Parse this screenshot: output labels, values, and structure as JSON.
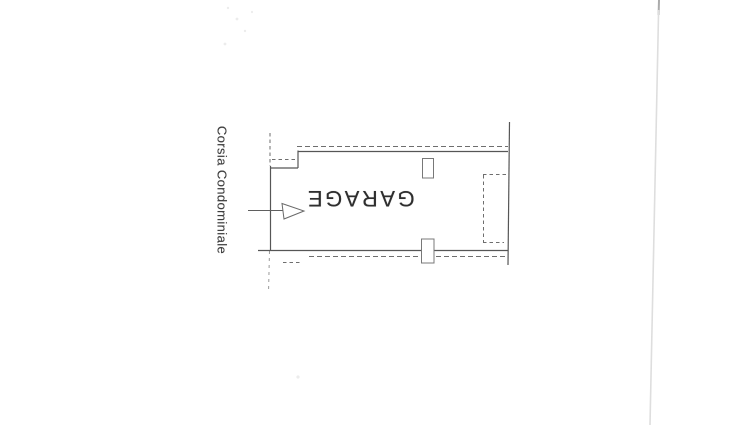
{
  "labels": {
    "room": "GARAGE",
    "driveway": "Corsia Condominiale"
  },
  "icons": {
    "entrance_arrow": "right-arrow"
  },
  "colors": {
    "background": "#ffffff",
    "line": "#565656",
    "dashed_line": "#6e6e6e",
    "room_text": "#2e2e2e",
    "driveway_text": "#3e3e3e",
    "page_edge": "#dedede"
  }
}
